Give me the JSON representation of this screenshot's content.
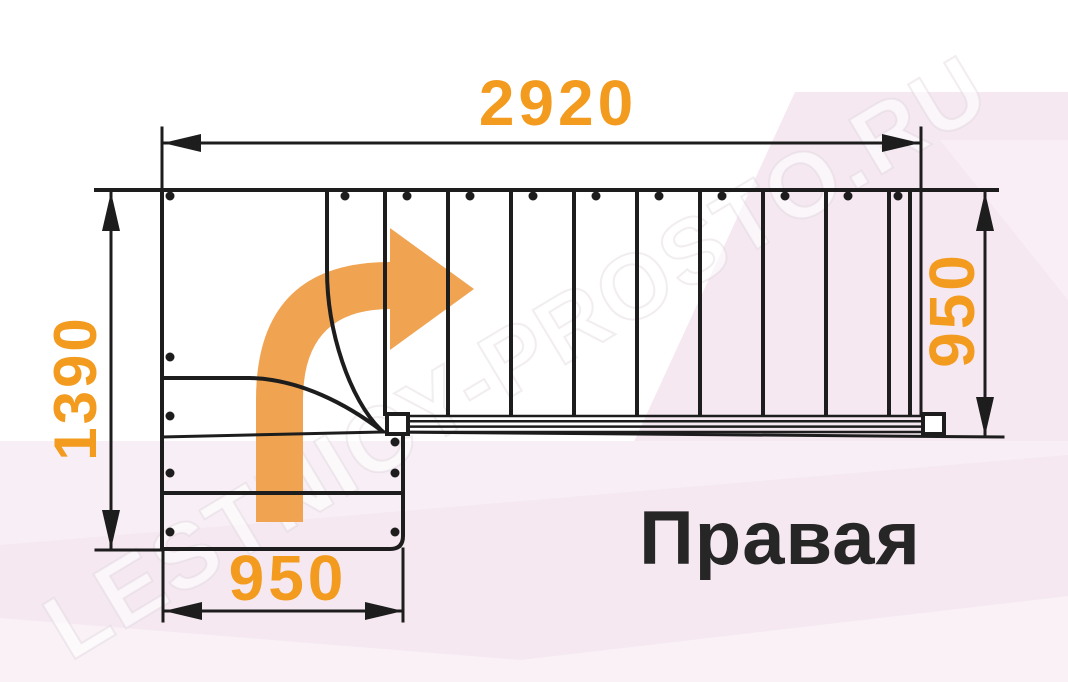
{
  "diagram": {
    "dimensions": {
      "top": "2920",
      "left": "1390",
      "bottom": "950",
      "right": "950"
    },
    "label": "Правая",
    "watermark": "LESTNICY-PROSTO.RU",
    "colors": {
      "ink": "#1d1d1d",
      "orange": "#F29B1E",
      "arrow": "#F0A351",
      "pink": "#f5e8f1",
      "pink_light": "#faeef6",
      "white": "#ffffff"
    }
  }
}
